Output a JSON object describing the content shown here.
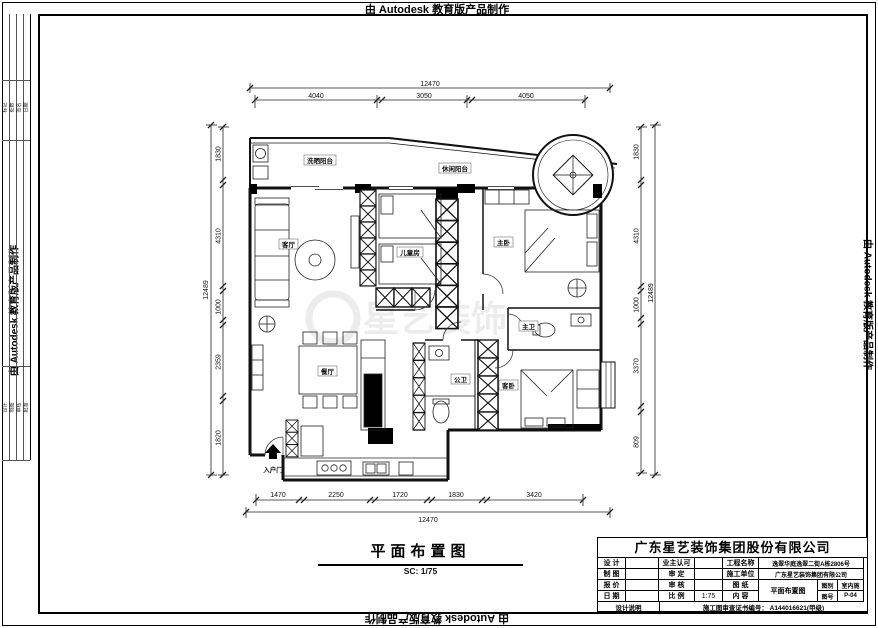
{
  "watermark": "由 Autodesk 教育版产品制作",
  "plan": {
    "title": "平面布置图",
    "scale_note": "SC: 1/75",
    "ghost_logo": "星艺装饰",
    "rooms": {
      "balcony_left": "洗晒阳台",
      "balcony_right": "休闲阳台",
      "kids": "儿童房",
      "master": "主卧",
      "living": "客厅",
      "dining": "餐厅",
      "bath_public": "公卫",
      "bath_master": "主卫",
      "guest": "客卧",
      "entry": "入户门"
    },
    "dims": {
      "top_total": "12470",
      "top": [
        "4040",
        "3050",
        "4050"
      ],
      "bottom": [
        "1470",
        "2250",
        "1720",
        "1830",
        "3420"
      ],
      "bottom_total": "12470",
      "left": [
        "1830",
        "4310",
        "1000",
        "2359",
        "1820"
      ],
      "left_total": "12489",
      "right": [
        "1830",
        "4310",
        "1000",
        "3370",
        "809"
      ],
      "right_total": "12489"
    }
  },
  "side_strip": {
    "band1": [
      "标记",
      "处数",
      "签名",
      "日期"
    ],
    "band2": [
      "设计",
      "制图",
      "审核",
      "批准"
    ]
  },
  "title_block": {
    "company": "广东星艺装饰集团股份有限公司",
    "rows": {
      "design": "设 计",
      "owner_ok": "业主认可",
      "project_label": "工程名称",
      "project_value": "逸翠华庭逸翠二街A栋2806号",
      "draft": "制 图",
      "approve": "审 定",
      "builder_label": "施工单位",
      "builder_value": "广东星艺装饰集团有限公司",
      "quote": "报 价",
      "check": "审 核",
      "sheet_label": "图 纸",
      "content_label": "内 容",
      "sheet_value": "平面布置图",
      "category_label": "图别",
      "category_value": "室内施",
      "date": "日 期",
      "scale_label": "比 例",
      "scale_value": "1:75",
      "no_label": "图号",
      "no_value": "P-04",
      "notes_label": "设计说明",
      "cert_label": "施工图审查证书编号：",
      "cert_value": "A144016621(甲级)"
    }
  }
}
